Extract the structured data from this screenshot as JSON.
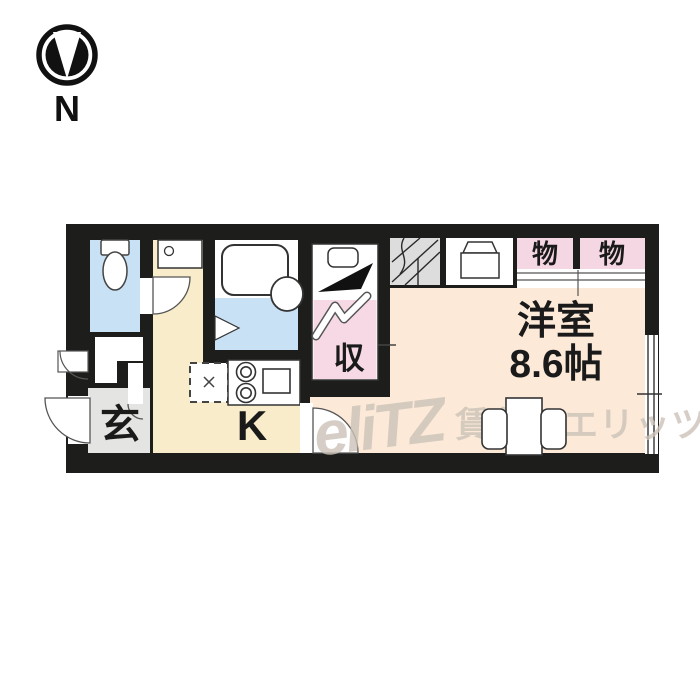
{
  "compass": {
    "label": "N"
  },
  "plan": {
    "entrance_label": "玄",
    "kitchen_label": "K",
    "closet_label": "収",
    "storage_left_label": "物",
    "storage_right_label": "物",
    "room_label": "洋室",
    "room_size": "8.6帖",
    "colors": {
      "wall": "#1d1d1b",
      "water_blue": "#c9e1f4",
      "kitchen_cream": "#f8ecca",
      "closet_pink": "#f7d9e5",
      "storage_pink": "#f5d6e3",
      "room_peach": "#fce9d8",
      "entrance_gray": "#e4e4e2",
      "stairs_gray": "#dddddd",
      "watermark_gray": "#ccc3b8"
    }
  },
  "watermark": {
    "logo": "eliTZ",
    "text": "賃貸のエリッツ"
  }
}
